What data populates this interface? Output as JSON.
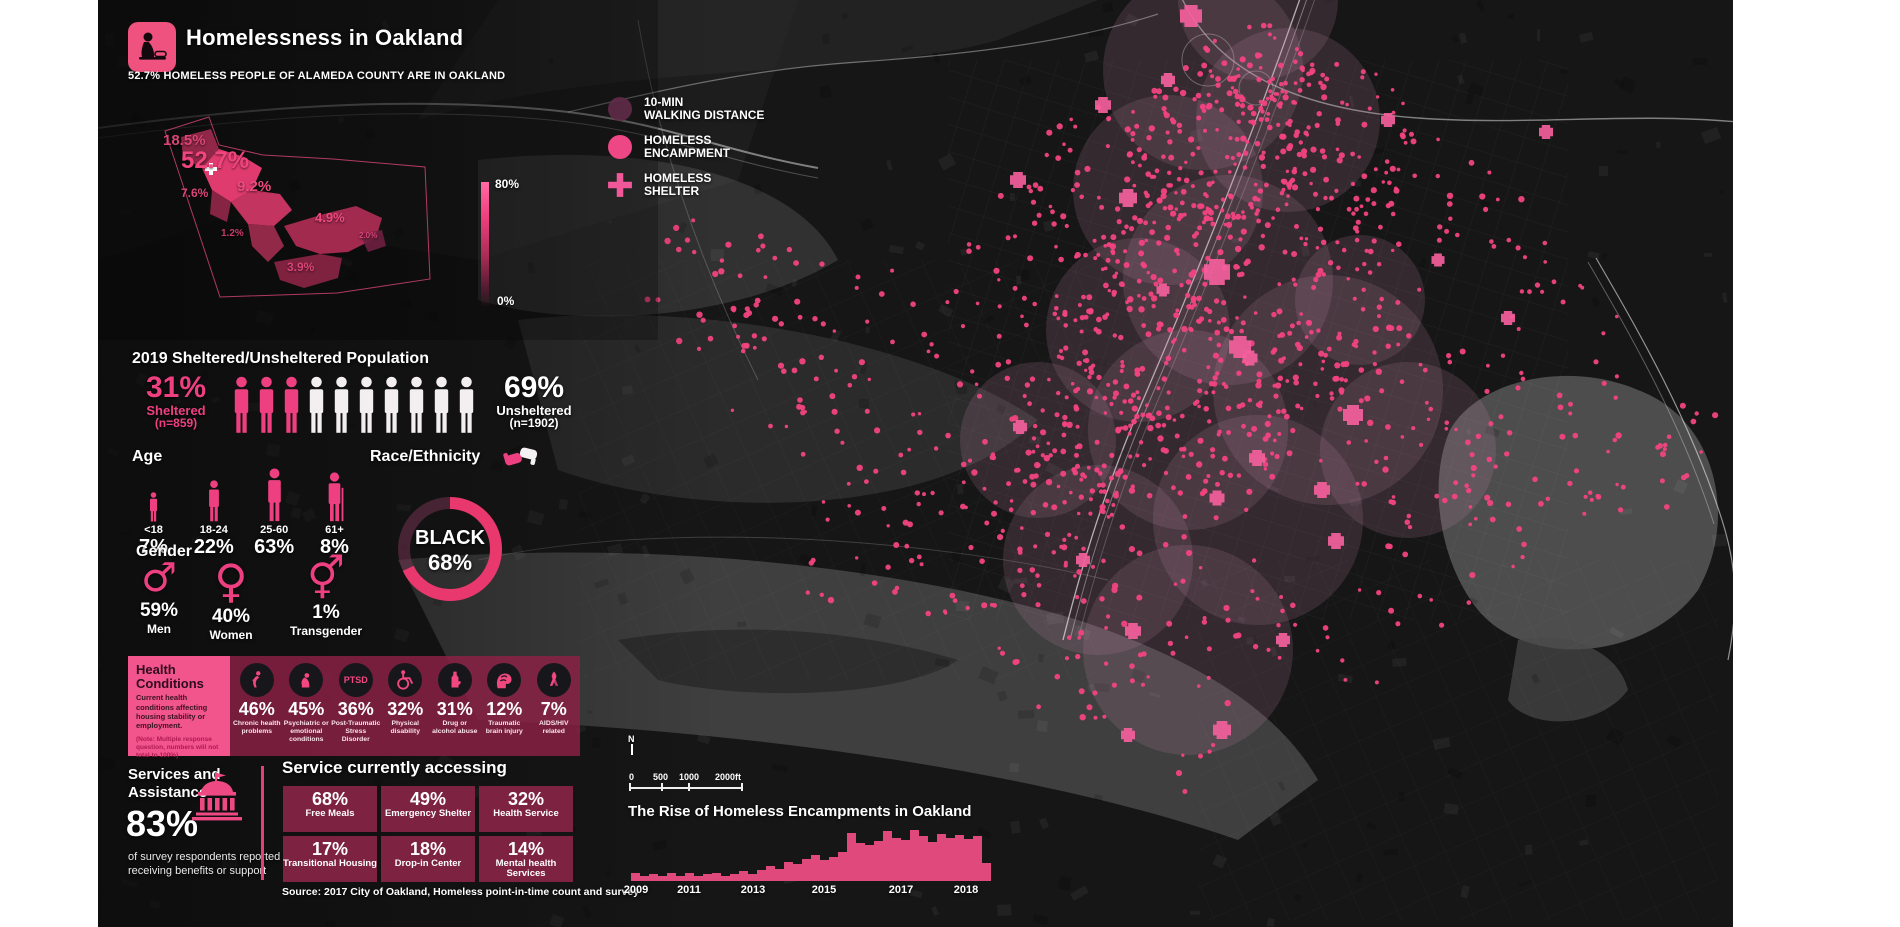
{
  "page": {
    "background": "#ffffff",
    "map_background": "#161616",
    "accent_pink": "#ee4081",
    "accent_maroon": "#7e2242"
  },
  "header": {
    "title": "Homelessness in Oakland",
    "subtitle": "52.7% HOMELESS PEOPLE OF ALAMEDA COUNTY ARE IN OAKLAND"
  },
  "county_map": {
    "labels": [
      {
        "text": "18.5%",
        "x": 40,
        "y": 28,
        "size": 15,
        "color": "#d94577"
      },
      {
        "text": "52.7%",
        "x": 58,
        "y": 44,
        "size": 24,
        "color": "#f2457f"
      },
      {
        "text": "7.6%",
        "x": 58,
        "y": 82,
        "size": 12,
        "color": "#d94577"
      },
      {
        "text": "9.2%",
        "x": 114,
        "y": 74,
        "size": 15,
        "color": "#ef4a80"
      },
      {
        "text": "1.2%",
        "x": 98,
        "y": 124,
        "size": 10,
        "color": "#c73a68"
      },
      {
        "text": "4.9%",
        "x": 192,
        "y": 106,
        "size": 13,
        "color": "#ef4a80"
      },
      {
        "text": "2.0%",
        "x": 236,
        "y": 127,
        "size": 8,
        "color": "#d94577"
      },
      {
        "text": "3.9%",
        "x": 164,
        "y": 156,
        "size": 12,
        "color": "#d94577"
      }
    ]
  },
  "scale_legend": {
    "top": "80%",
    "bottom": "0%"
  },
  "map_legend": {
    "items": [
      {
        "symbol": "walk-circle",
        "label": [
          "10-MIN",
          "WALKING DISTANCE"
        ]
      },
      {
        "symbol": "encampment-dot",
        "label": [
          "HOMELESS",
          "ENCAMPMENT"
        ]
      },
      {
        "symbol": "shelter-cross",
        "label": [
          "HOMELESS",
          "SHELTER"
        ]
      }
    ]
  },
  "population": {
    "title": "2019 Sheltered/Unsheltered Population",
    "icons_total": 10,
    "icons_pink": 3,
    "sheltered": {
      "pct": "31%",
      "label": "Sheltered",
      "n": "(n=859)"
    },
    "unsheltered": {
      "pct": "69%",
      "label": "Unsheltered",
      "n": "(n=1902)"
    }
  },
  "age": {
    "title": "Age",
    "groups": [
      {
        "range": "<18",
        "pct": "7%"
      },
      {
        "range": "18-24",
        "pct": "22%"
      },
      {
        "range": "25-60",
        "pct": "63%"
      },
      {
        "range": "61+",
        "pct": "8%"
      }
    ]
  },
  "race": {
    "title": "Race/Ethnicity",
    "label": "BLACK",
    "pct": "68%",
    "value": 68
  },
  "gender": {
    "title": "Gender",
    "groups": [
      {
        "symbol": "♂",
        "pct": "59%",
        "label": "Men"
      },
      {
        "symbol": "♀",
        "pct": "40%",
        "label": "Women"
      },
      {
        "symbol": "⚥",
        "pct": "1%",
        "label": "Transgender"
      }
    ]
  },
  "health": {
    "title": "Health Conditions",
    "desc": "Current health conditions affecting housing stability or employment.",
    "note": "(Note: Multiple response question, numbers will not total to 100%)",
    "items": [
      {
        "pct": "46%",
        "label": "Chronic health problems",
        "icon": "chronic"
      },
      {
        "pct": "45%",
        "label": "Psychiatric or emotional conditions",
        "icon": "psych"
      },
      {
        "pct": "36%",
        "label": "Post-Traumatic Stress Disorder",
        "icon": "ptsd",
        "icon_text": "PTSD"
      },
      {
        "pct": "32%",
        "label": "Physical disability",
        "icon": "wheelchair"
      },
      {
        "pct": "31%",
        "label": "Drug or alcohol abuse",
        "icon": "bottle"
      },
      {
        "pct": "12%",
        "label": "Traumatic brain injury",
        "icon": "brain"
      },
      {
        "pct": "7%",
        "label": "AIDS/HIV related",
        "icon": "ribbon"
      }
    ]
  },
  "services": {
    "title": "Services and Assistance",
    "pct": "83%",
    "desc": "of survey respondents reported receiving benefits or support"
  },
  "accessing": {
    "title": "Service currently accessing",
    "items": [
      {
        "pct": "68%",
        "label": "Free Meals"
      },
      {
        "pct": "49%",
        "label": "Emergency Shelter"
      },
      {
        "pct": "32%",
        "label": "Health Service"
      },
      {
        "pct": "17%",
        "label": "Transitional Housing"
      },
      {
        "pct": "18%",
        "label": "Drop-in Center"
      },
      {
        "pct": "14%",
        "label": "Mental health Services"
      }
    ],
    "source": "Source: 2017 City of Oakland, Homeless point-in-time count and survey"
  },
  "scalebar": {
    "north": "N",
    "labels": [
      {
        "text": "0",
        "x": 0
      },
      {
        "text": "500",
        "x": 24
      },
      {
        "text": "1000",
        "x": 50
      },
      {
        "text": "2000ft",
        "x": 86
      }
    ],
    "ticks": [
      0,
      32,
      59,
      112
    ]
  },
  "chart_data": {
    "type": "bar",
    "title": "The Rise of Homeless Encampments in Oakland",
    "x": "year (quarterly bars, 2009-2018)",
    "values": [
      16,
      9,
      13,
      9,
      15,
      10,
      16,
      10,
      13,
      16,
      10,
      13,
      19,
      13,
      21,
      30,
      24,
      37,
      33,
      44,
      52,
      41,
      48,
      56,
      95,
      75,
      70,
      78,
      98,
      85,
      80,
      100,
      88,
      76,
      92,
      84,
      90,
      82,
      88,
      35
    ],
    "ylim": [
      0,
      100
    ],
    "x_tick_labels": [
      "2009",
      "2011",
      "2013",
      "2015",
      "2017",
      "2018"
    ],
    "x_tick_pos": [
      1.5,
      16,
      34,
      53.5,
      75,
      93
    ],
    "bar_color": "#e0497c"
  },
  "map": {
    "dot_color": "#f2437f",
    "cross_color": "#f45f9c",
    "walk_circle_color": "rgba(206,141,173,0.16)",
    "walk_circles": [
      [
        1105,
        70,
        100
      ],
      [
        1190,
        120,
        92
      ],
      [
        1070,
        190,
        95
      ],
      [
        1130,
        280,
        105
      ],
      [
        1040,
        330,
        92
      ],
      [
        1230,
        390,
        115
      ],
      [
        1090,
        430,
        100
      ],
      [
        1160,
        520,
        105
      ],
      [
        1000,
        560,
        95
      ],
      [
        1090,
        650,
        105
      ],
      [
        1310,
        450,
        88
      ],
      [
        940,
        440,
        78
      ],
      [
        1262,
        300,
        65
      ],
      [
        1160,
        0,
        80
      ]
    ],
    "crosses": [
      [
        1093,
        16,
        22
      ],
      [
        1005,
        105,
        16
      ],
      [
        920,
        180,
        16
      ],
      [
        1030,
        198,
        18
      ],
      [
        1070,
        80,
        14
      ],
      [
        1119,
        272,
        26
      ],
      [
        1065,
        290,
        13
      ],
      [
        1142,
        347,
        22
      ],
      [
        1152,
        358,
        15
      ],
      [
        1255,
        415,
        20
      ],
      [
        1159,
        458,
        16
      ],
      [
        1119,
        498,
        15
      ],
      [
        1224,
        490,
        16
      ],
      [
        922,
        427,
        14
      ],
      [
        1238,
        541,
        16
      ],
      [
        985,
        560,
        14
      ],
      [
        1035,
        631,
        16
      ],
      [
        1185,
        640,
        14
      ],
      [
        1124,
        730,
        18
      ],
      [
        1030,
        735,
        14
      ],
      [
        1410,
        318,
        14
      ],
      [
        1340,
        260,
        13
      ],
      [
        1290,
        120,
        14
      ],
      [
        1448,
        132,
        14
      ]
    ],
    "dot_clusters": [
      [
        1120,
        150,
        95,
        130
      ],
      [
        1080,
        255,
        85,
        110
      ],
      [
        1040,
        355,
        85,
        100
      ],
      [
        1000,
        450,
        75,
        85
      ],
      [
        1160,
        85,
        75,
        70
      ],
      [
        1235,
        140,
        85,
        60
      ],
      [
        950,
        520,
        75,
        50
      ],
      [
        700,
        330,
        120,
        45
      ],
      [
        800,
        435,
        105,
        40
      ],
      [
        620,
        280,
        85,
        25
      ],
      [
        1300,
        420,
        100,
        45
      ],
      [
        1420,
        470,
        90,
        30
      ],
      [
        1540,
        455,
        70,
        18
      ],
      [
        1240,
        300,
        85,
        40
      ],
      [
        1100,
        600,
        95,
        35
      ],
      [
        980,
        640,
        85,
        25
      ],
      [
        1350,
        555,
        85,
        20
      ],
      [
        870,
        555,
        75,
        20
      ],
      [
        1460,
        350,
        75,
        18
      ],
      [
        1595,
        430,
        55,
        10
      ],
      [
        1180,
        370,
        70,
        60
      ],
      [
        1130,
        450,
        70,
        50
      ],
      [
        900,
        350,
        80,
        30
      ],
      [
        1230,
        220,
        80,
        50
      ],
      [
        1010,
        180,
        80,
        40
      ],
      [
        940,
        260,
        80,
        30
      ],
      [
        1330,
        190,
        70,
        20
      ],
      [
        1430,
        240,
        60,
        12
      ],
      [
        760,
        540,
        80,
        18
      ],
      [
        1070,
        720,
        80,
        15
      ],
      [
        1240,
        640,
        70,
        12
      ]
    ]
  }
}
